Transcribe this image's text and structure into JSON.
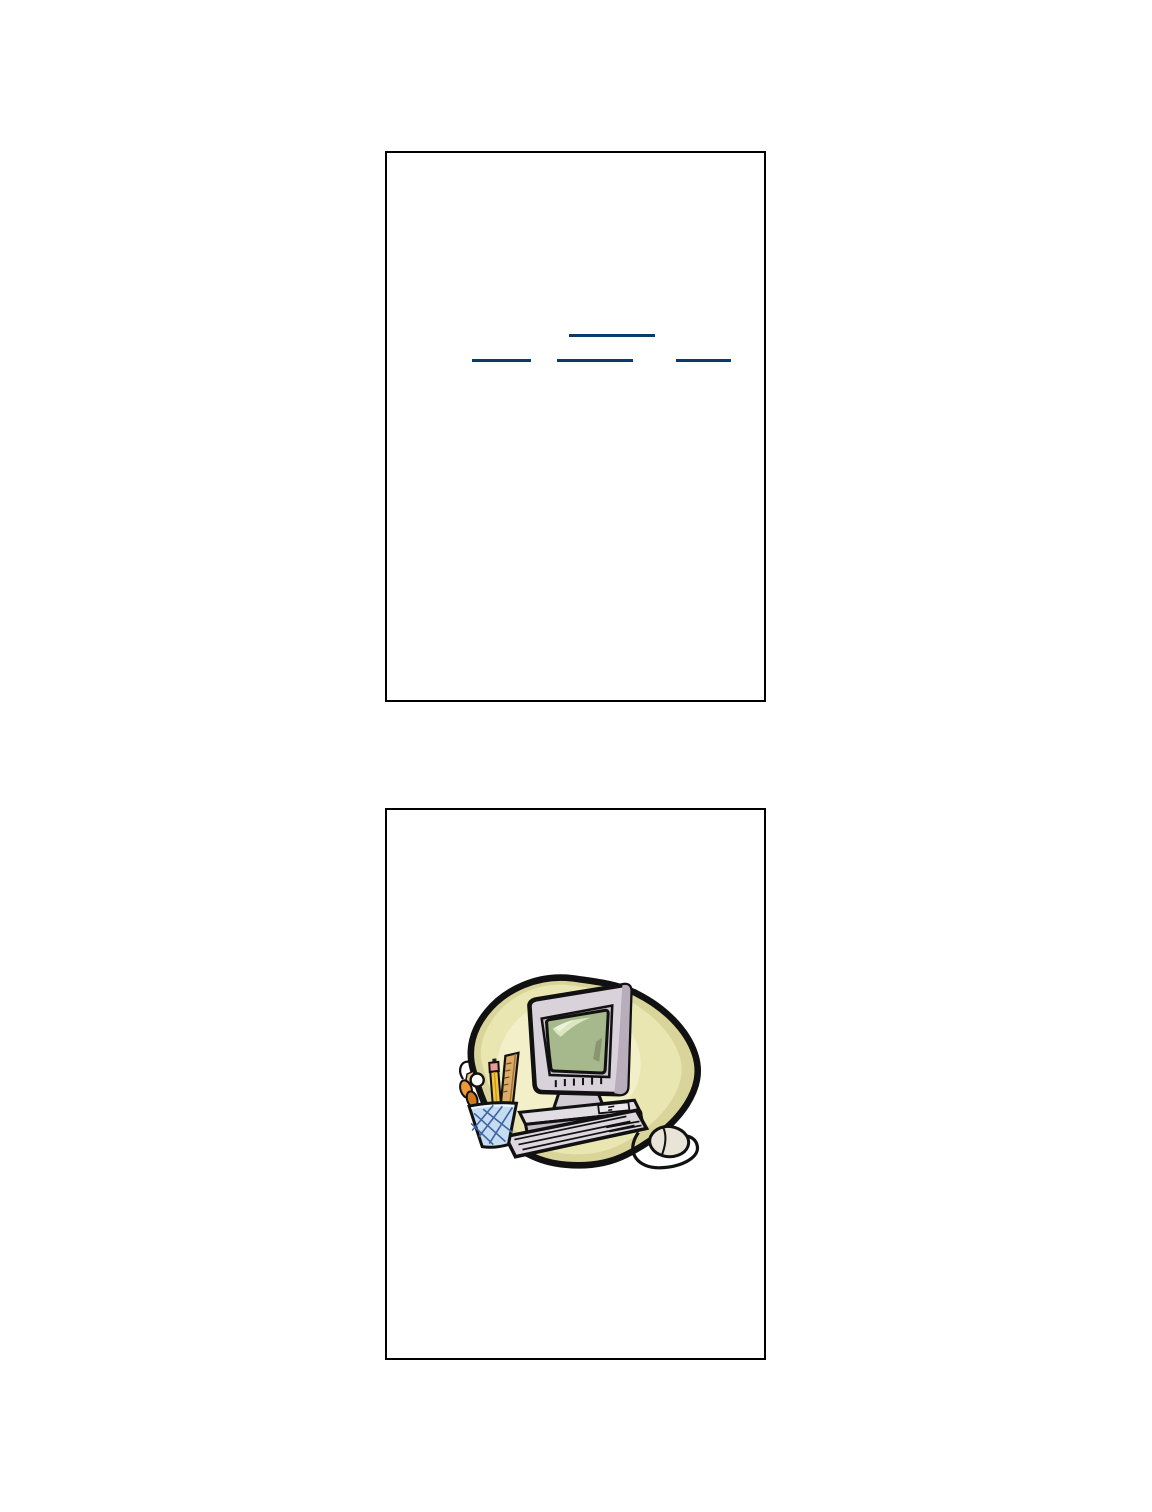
{
  "page": {
    "type": "document-page",
    "background": "#ffffff"
  },
  "slide1": {
    "name": "slide-frame-1",
    "hyperlinks": [
      {
        "position": "center-top",
        "text": ""
      },
      {
        "position": "bottom-left",
        "text": ""
      },
      {
        "position": "bottom-center",
        "text": ""
      },
      {
        "position": "bottom-right",
        "text": ""
      }
    ]
  },
  "slide2": {
    "name": "slide-frame-2",
    "image": "computer-clipart"
  },
  "colors": {
    "frame_border": "#000000",
    "hyperlink_underline": "#0a3a68",
    "clipart_outline": "#111111",
    "blob_outer": "#d9d59a",
    "blob_mid": "#e9e6b2",
    "blob_core": "#f2efc9",
    "monitor_case": "#d9d2da",
    "monitor_case_shade": "#b7adbb",
    "monitor_bezel": "#c9c1cb",
    "screen": "#a5b98c",
    "screen_highlight": "#dce6bf",
    "screen_glare": "#edf2da",
    "screen_shadow": "#8b9671",
    "stand": "#d3ccd5",
    "case_top": "#e2dce3",
    "case_front": "#c4bcc7",
    "slot": "#eee8ee",
    "keyboard": "#ded7df",
    "mouse": "#e9e4d8",
    "cup": "#c6ddf1",
    "cup_hatch": "#3f63a4",
    "pencil": "#f3c640",
    "pencil_facet": "#cf9a1f",
    "eraser": "#ea9a9a",
    "ruler": "#d9ad68",
    "ruler_edge": "#a4713a",
    "scissors_handle": "#ee9838",
    "scissors_handle_dark": "#cf7a1c",
    "scissors_blade": "#f0c58a"
  }
}
